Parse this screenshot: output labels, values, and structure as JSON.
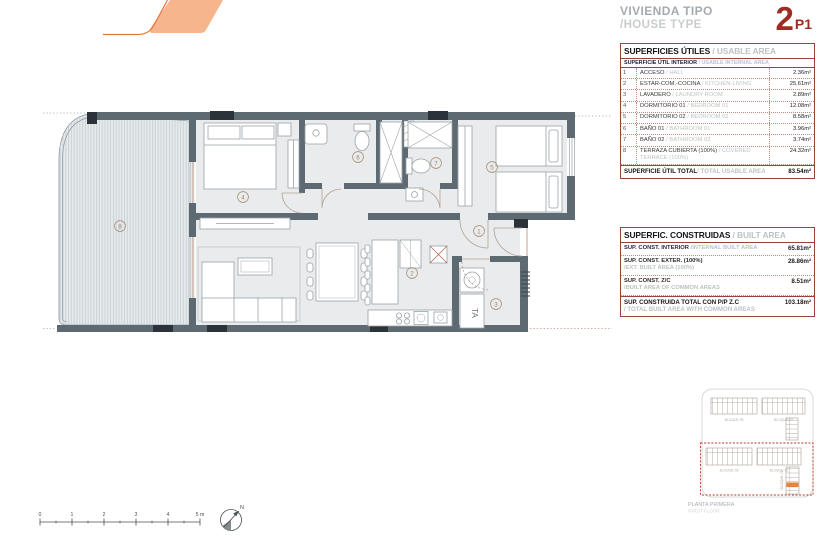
{
  "header": {
    "title_es": "VIVIENDA TIPO",
    "title_en": "/HOUSE TYPE",
    "unit_number": "2",
    "unit_floor": "P1"
  },
  "usable_table": {
    "title_es": "SUPERFICIES ÚTILES",
    "title_en": " / USABLE AREA",
    "subheader_es": "SUPERFICIE ÚTIL INTERIOR",
    "subheader_en": " / USABLE INTERNAL AREA",
    "rows": [
      {
        "num": "1",
        "es": "ACCESO",
        "en": " / HALL",
        "value": "2.36m²"
      },
      {
        "num": "2",
        "es": "ESTAR-COM.-COCINA",
        "en": " / KITCHEN-LIVING",
        "value": "25.61m²"
      },
      {
        "num": "3",
        "es": "LAVADERO",
        "en": " / LAUNDRY ROOM",
        "value": "2.89m²"
      },
      {
        "num": "4",
        "es": "DORMITORIO 01",
        "en": " / BEDROOM 01",
        "value": "12.08m²"
      },
      {
        "num": "5",
        "es": "DORMITORIO 02",
        "en": " / BEDROOM 02",
        "value": "8.58m²"
      },
      {
        "num": "6",
        "es": "BAÑO 01",
        "en": " / BATHROOM 01",
        "value": "3.96m²"
      },
      {
        "num": "7",
        "es": "BAÑO 02",
        "en": " / BATHROOM 02",
        "value": "3.74m²"
      },
      {
        "num": "8",
        "es": "TERRAZA CUBIERTA (100%)",
        "en": " / COVERED TERRACE (100%)",
        "value": "24.32m²"
      }
    ],
    "total_es": "SUPERFICIE ÚTIL TOTAL",
    "total_en": " / TOTAL USABLE AREA",
    "total_value": "83.54m²"
  },
  "built_table": {
    "title_es": "SUPERFIC. CONSTRUIDAS",
    "title_en": " / BUILT AREA",
    "rows": [
      {
        "es": "SUP. CONST. INTERIOR",
        "en": " /INTERNAL BUILT AREA",
        "value": "65.81m²"
      },
      {
        "es": "SUP. CONST. EXTER. (100%)",
        "en": " /EXT. BUILT AREA (100%)",
        "value": "28.86m²"
      },
      {
        "es": "SUP. CONST. Z/C",
        "en": " /BUILT AREA OF COMMON AREAS",
        "value": "8.51m²"
      }
    ],
    "total_es": "SUP. CONSTRUIDA TOTAL CON P/P Z.C",
    "total_en": "/ TOTAL BUILT AREA WITH COMMON AREAS",
    "total_value": "103.18m²"
  },
  "plan": {
    "rooms": {
      "n1": "1",
      "n2": "2",
      "n3": "3",
      "n4": "4",
      "n5": "5",
      "n6": "6",
      "n7": "7",
      "n8": "8"
    },
    "laundry_tag": "TA"
  },
  "scale_bar": {
    "t0": "0",
    "t1": "1",
    "t2": "2",
    "t3": "3",
    "t4": "4",
    "t5": "5 m",
    "north": "N"
  },
  "site_plan": {
    "caption_es": "PLANTA PRIMERA",
    "caption_en": "/FIRST FLOOR",
    "block_05": "BLOQUE 05",
    "block_04": "BLOQUE 04",
    "block_03": "BLOQUE 03",
    "block_02": "BLOQUE 02",
    "block_01": "BLOQUE 01"
  },
  "colors": {
    "accent_red": "#9d2c24",
    "table_border": "#9a4238",
    "wall": "#5d6a72",
    "logo_orange": "#f6b58c",
    "logo_line": "#e2773d",
    "site_red_dash": "#b5352b",
    "unit_highlight": "#e8823c"
  }
}
